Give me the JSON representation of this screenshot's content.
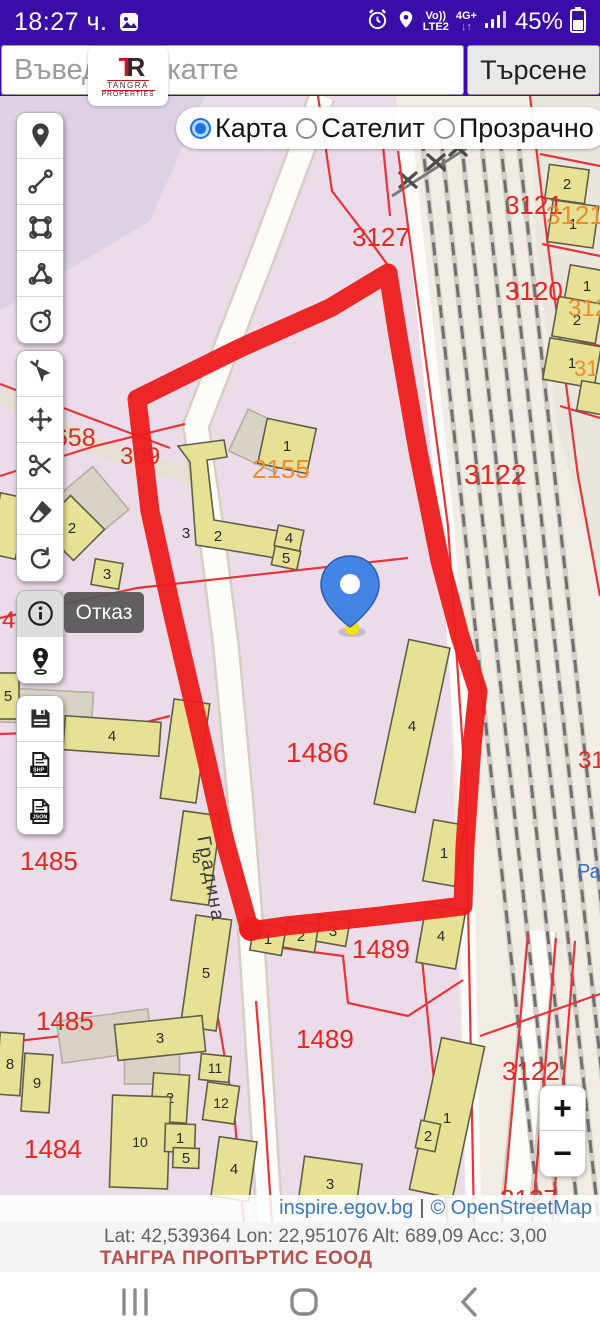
{
  "status_bar": {
    "time": "18:27 ч.",
    "volte": "Vo))",
    "lte": "LTE2",
    "net": "4G+",
    "battery": "45%"
  },
  "search": {
    "placeholder": "Въведете екатте",
    "button": "Търсене",
    "logo": {
      "mono_t": "T",
      "mono_r": "R",
      "name": "TANGRA",
      "type": "PROPERTIES"
    }
  },
  "map_type": {
    "options": [
      {
        "label": "Карта",
        "selected": true
      },
      {
        "label": "Сателит",
        "selected": false
      },
      {
        "label": "Прозрачно",
        "selected": false
      }
    ]
  },
  "toolbar": {
    "groups": [
      {
        "top": 16,
        "buttons": [
          {
            "name": "marker-pin"
          },
          {
            "name": "measure-line"
          },
          {
            "name": "measure-polygon"
          },
          {
            "name": "measure-angle"
          },
          {
            "name": "measure-circle"
          }
        ]
      },
      {
        "top": 254,
        "buttons": [
          {
            "name": "select-cursor"
          },
          {
            "name": "pan-move"
          },
          {
            "name": "cut-scissors"
          },
          {
            "name": "eraser"
          },
          {
            "name": "rotate-undo"
          }
        ]
      },
      {
        "top": 494,
        "buttons": [
          {
            "name": "info",
            "active": true
          },
          {
            "name": "person-locate"
          }
        ]
      },
      {
        "top": 599,
        "buttons": [
          {
            "name": "save-floppy"
          },
          {
            "name": "export-shp"
          },
          {
            "name": "export-json"
          }
        ]
      }
    ]
  },
  "cancel_label": "Отказ",
  "zoom_controls": {
    "zoom_in": "+",
    "zoom_out": "−"
  },
  "attribution": {
    "site": "inspire.egov.bg",
    "sep": "|",
    "osm": "© OpenStreetMap"
  },
  "footer": {
    "coords": "Lat: 42,539364 Lon: 22,951076 Alt: 689,09 Acc: 3,00",
    "company": "ТАНГРА ПРОПЪРТИС ЕООД"
  },
  "colors": {
    "statusbar_bg": "#3a0ca8",
    "accent_blue": "#1a73e8",
    "parcel_bg": "#ecdbe9",
    "topleft_bg": "#ddd2e4",
    "rail_bg": "#f1ede4",
    "right_parcel_bg": "#e9e6dd",
    "road_fill": "#fdfcf9",
    "road_casing": "#d6d0c3",
    "road_grey": "#e6e0d3",
    "building_fill": "#e7e195",
    "building_stroke": "#5f5f45",
    "grey_building": "#d9d2c7",
    "grey_stroke": "#b4ada0",
    "boundary_red": "#e8333a",
    "label_red": "#e02925",
    "label_orange": "#ee8a2f",
    "label_blue": "#3a6fc0",
    "marker_red": "#ed1c1c",
    "pin_blue": "#4484e4",
    "pin_dark": "#2a5cb0",
    "pin_tip_yellow": "#f0e400",
    "track_grey": "#6f6f6f",
    "street_text": "#3a3a3a"
  },
  "map": {
    "street_label": {
      "text": "Градина",
      "x": 205,
      "y": 784,
      "rot": 80
    },
    "regions": [
      {
        "pts": "0,0 205,0 150,125 0,215",
        "fill": "topleft_bg"
      },
      {
        "pts": "396,0 600,0 600,1127 466,1127 446,430",
        "fill": "rail_bg"
      },
      {
        "pts": "531,0 600,0 600,490 557,330 536,140",
        "fill": "right_parcel_bg"
      }
    ],
    "roads": [
      {
        "pts": "0,298 95,350 196,382",
        "w": 17,
        "kind": "grey"
      },
      {
        "pts": "322,0 262,160 196,330 212,440 226,550 240,700 252,850 262,1005 270,1127",
        "w": 23,
        "kind": "white"
      },
      {
        "pts": "404,30 446,420 465,690 474,1127",
        "w": 15,
        "kind": "plain"
      },
      {
        "pts": "542,835 514,1127",
        "w": 26,
        "kind": "white"
      }
    ],
    "rails": {
      "x_tops": [
        422,
        441,
        461,
        481,
        500,
        518
      ],
      "dx": 118,
      "y0": 42,
      "y1": 1127
    },
    "xline": {
      "pts": "392,100 470,50"
    },
    "xmarks": [
      [
        408,
        84
      ],
      [
        436,
        66
      ],
      [
        458,
        52
      ]
    ],
    "boundaries": [
      "398,55 448,430 466,700 474,1127",
      "530,0 548,150 578,380 600,500",
      "540,58 600,70",
      "542,148 600,160",
      "552,238 600,250",
      "560,310 600,322",
      "0,380 95,350 185,328",
      "0,288 90,322 170,352",
      "0,522 137,492 408,462",
      "0,638 115,634 170,620",
      "0,947 218,922",
      "218,922 234,1015 244,1127",
      "256,905 264,1005 272,1127",
      "252,848 343,860 348,907 408,920 463,884",
      "420,842 448,1127",
      "528,838 502,1127",
      "556,842 532,1127",
      "575,845 552,1127",
      "480,940 600,898",
      "318,0 332,95 368,142 392,175",
      "382,40 390,120"
    ],
    "buildings": [
      {
        "x": 262,
        "y": 345,
        "w": 52,
        "h": 46,
        "r": 25,
        "n": "",
        "f": "g"
      },
      {
        "x": 87,
        "y": 412,
        "w": 62,
        "h": 56,
        "r": -40,
        "n": "",
        "f": "g"
      },
      {
        "x": 45,
        "y": 611,
        "w": 95,
        "h": 34,
        "r": 3,
        "n": "",
        "f": "g"
      },
      {
        "x": 105,
        "y": 940,
        "w": 92,
        "h": 42,
        "r": -8,
        "n": "",
        "f": "g"
      },
      {
        "x": 152,
        "y": 968,
        "w": 55,
        "h": 40,
        "r": 0,
        "n": "",
        "f": "g"
      },
      {
        "x": 567,
        "y": 88,
        "w": 40,
        "h": 34,
        "r": 8,
        "n": "2",
        "f": "y"
      },
      {
        "x": 573,
        "y": 128,
        "w": 46,
        "h": 42,
        "r": 8,
        "n": "1",
        "f": "y"
      },
      {
        "x": 587,
        "y": 190,
        "w": 40,
        "h": 36,
        "r": 10,
        "n": "1",
        "f": "y"
      },
      {
        "x": 577,
        "y": 224,
        "w": 44,
        "h": 40,
        "r": 10,
        "n": "2",
        "f": "y"
      },
      {
        "x": 572,
        "y": 267,
        "w": 52,
        "h": 42,
        "r": 10,
        "n": "1",
        "f": "y"
      },
      {
        "x": 594,
        "y": 302,
        "w": 30,
        "h": 30,
        "r": 10,
        "n": "",
        "f": "y"
      },
      {
        "x": 287,
        "y": 350,
        "w": 50,
        "h": 46,
        "r": 12,
        "n": "1",
        "f": "y"
      },
      {
        "pts": "178,350 224,344 227,361 207,364 214,424 284,436 281,463 228,454 196,449 190,366",
        "n": "",
        "f": "y"
      },
      {
        "x": 218,
        "y": 440,
        "w": 0,
        "h": 0,
        "r": 0,
        "n": "2",
        "f": "t"
      },
      {
        "x": 186,
        "y": 437,
        "w": 0,
        "h": 0,
        "r": 0,
        "n": "3",
        "f": "t"
      },
      {
        "x": 289,
        "y": 442,
        "w": 26,
        "h": 21,
        "r": 12,
        "n": "4",
        "f": "y"
      },
      {
        "x": 286,
        "y": 462,
        "w": 26,
        "h": 19,
        "r": 12,
        "n": "5",
        "f": "y"
      },
      {
        "x": 72,
        "y": 432,
        "w": 48,
        "h": 44,
        "r": 45,
        "n": "2",
        "f": "y"
      },
      {
        "x": 107,
        "y": 478,
        "w": 28,
        "h": 26,
        "r": 10,
        "n": "3",
        "f": "y"
      },
      {
        "x": 8,
        "y": 430,
        "w": 28,
        "h": 62,
        "r": 12,
        "n": "",
        "f": "y"
      },
      {
        "x": 8,
        "y": 600,
        "w": 22,
        "h": 46,
        "r": 0,
        "n": "5",
        "f": "y"
      },
      {
        "x": 112,
        "y": 640,
        "w": 96,
        "h": 34,
        "r": 4,
        "n": "4",
        "f": "y"
      },
      {
        "x": 185,
        "y": 655,
        "w": 36,
        "h": 100,
        "r": 8,
        "n": "",
        "f": "y"
      },
      {
        "x": 196,
        "y": 762,
        "w": 38,
        "h": 90,
        "r": 8,
        "n": "5",
        "f": "y"
      },
      {
        "x": 206,
        "y": 877,
        "w": 36,
        "h": 112,
        "r": 8,
        "n": "5",
        "f": "y"
      },
      {
        "x": 412,
        "y": 630,
        "w": 42,
        "h": 168,
        "r": 12,
        "n": "4",
        "f": "y"
      },
      {
        "x": 444,
        "y": 757,
        "w": 32,
        "h": 62,
        "r": 10,
        "n": "1",
        "f": "y"
      },
      {
        "x": 268,
        "y": 843,
        "w": 32,
        "h": 28,
        "r": 10,
        "n": "1",
        "f": "y"
      },
      {
        "x": 301,
        "y": 840,
        "w": 32,
        "h": 28,
        "r": 10,
        "n": "2",
        "f": "y"
      },
      {
        "x": 333,
        "y": 835,
        "w": 30,
        "h": 26,
        "r": 10,
        "n": "3",
        "f": "y"
      },
      {
        "x": 441,
        "y": 840,
        "w": 40,
        "h": 60,
        "r": 10,
        "n": "4",
        "f": "y"
      },
      {
        "x": 447,
        "y": 1022,
        "w": 44,
        "h": 155,
        "r": 12,
        "n": "1",
        "f": "y"
      },
      {
        "x": 428,
        "y": 1040,
        "w": 20,
        "h": 28,
        "r": 12,
        "n": "2",
        "f": "y"
      },
      {
        "x": 330,
        "y": 1088,
        "w": 58,
        "h": 48,
        "r": 8,
        "n": "3",
        "f": "y"
      },
      {
        "x": 160,
        "y": 942,
        "w": 88,
        "h": 36,
        "r": -6,
        "n": "3",
        "f": "y"
      },
      {
        "x": 10,
        "y": 968,
        "w": 24,
        "h": 62,
        "r": 4,
        "n": "8",
        "f": "y"
      },
      {
        "x": 37,
        "y": 987,
        "w": 28,
        "h": 58,
        "r": 4,
        "n": "9",
        "f": "y"
      },
      {
        "x": 215,
        "y": 972,
        "w": 30,
        "h": 26,
        "r": 6,
        "n": "11",
        "f": "y"
      },
      {
        "x": 170,
        "y": 1002,
        "w": 36,
        "h": 48,
        "r": 4,
        "n": "2",
        "f": "y"
      },
      {
        "x": 140,
        "y": 1046,
        "w": 58,
        "h": 92,
        "r": 2,
        "n": "10",
        "f": "y"
      },
      {
        "x": 221,
        "y": 1007,
        "w": 32,
        "h": 38,
        "r": 8,
        "n": "12",
        "f": "y"
      },
      {
        "x": 180,
        "y": 1042,
        "w": 30,
        "h": 28,
        "r": 2,
        "n": "1",
        "f": "y"
      },
      {
        "x": 186,
        "y": 1062,
        "w": 26,
        "h": 20,
        "r": 2,
        "n": "5",
        "f": "y"
      },
      {
        "x": 234,
        "y": 1073,
        "w": 38,
        "h": 60,
        "r": 8,
        "n": "4",
        "f": "y"
      }
    ],
    "labels": [
      {
        "t": "3127",
        "x": 352,
        "y": 150,
        "c": "red",
        "s": 26
      },
      {
        "t": "3121",
        "x": 505,
        "y": 118,
        "c": "red",
        "s": 26
      },
      {
        "t": "3121",
        "x": 546,
        "y": 128,
        "c": "orange",
        "s": 26
      },
      {
        "t": "3120",
        "x": 505,
        "y": 204,
        "c": "red",
        "s": 26
      },
      {
        "t": "3120",
        "x": 568,
        "y": 220,
        "c": "orange",
        "s": 24
      },
      {
        "t": "31",
        "x": 574,
        "y": 280,
        "c": "orange",
        "s": 22
      },
      {
        "t": "3122",
        "x": 464,
        "y": 388,
        "c": "red",
        "s": 28
      },
      {
        "t": "2155",
        "x": 252,
        "y": 382,
        "c": "orange",
        "s": 26
      },
      {
        "t": "9658",
        "x": 40,
        "y": 350,
        "c": "red",
        "s": 25
      },
      {
        "t": "309",
        "x": 120,
        "y": 368,
        "c": "red",
        "s": 24
      },
      {
        "t": "48",
        "x": 2,
        "y": 532,
        "c": "red",
        "s": 24
      },
      {
        "t": "1486",
        "x": 286,
        "y": 666,
        "c": "red",
        "s": 28
      },
      {
        "t": "1485",
        "x": 20,
        "y": 774,
        "c": "red",
        "s": 26
      },
      {
        "t": "1489",
        "x": 352,
        "y": 862,
        "c": "red",
        "s": 26
      },
      {
        "t": "1485",
        "x": 36,
        "y": 934,
        "c": "red",
        "s": 26
      },
      {
        "t": "1489",
        "x": 296,
        "y": 952,
        "c": "red",
        "s": 26
      },
      {
        "t": "1484",
        "x": 24,
        "y": 1062,
        "c": "red",
        "s": 26
      },
      {
        "t": "3122",
        "x": 502,
        "y": 984,
        "c": "red",
        "s": 26
      },
      {
        "t": "3127",
        "x": 500,
        "y": 1112,
        "c": "red",
        "s": 26
      },
      {
        "t": "31",
        "x": 578,
        "y": 672,
        "c": "red",
        "s": 24
      },
      {
        "t": "Ра",
        "x": 577,
        "y": 782,
        "c": "blue",
        "s": 20
      }
    ],
    "outline": "M137,303 L240,252 L330,212 L388,177 L398,240 L418,355 L440,465 L460,540 L478,595 L472,650 L465,750 L463,810 L380,820 L285,830 L250,835 L225,745 L200,635 L172,515 L150,415 Z",
    "outline_blob": {
      "x": 251,
      "y": 833,
      "r": 12
    },
    "pin": {
      "x": 350,
      "y": 490
    }
  }
}
